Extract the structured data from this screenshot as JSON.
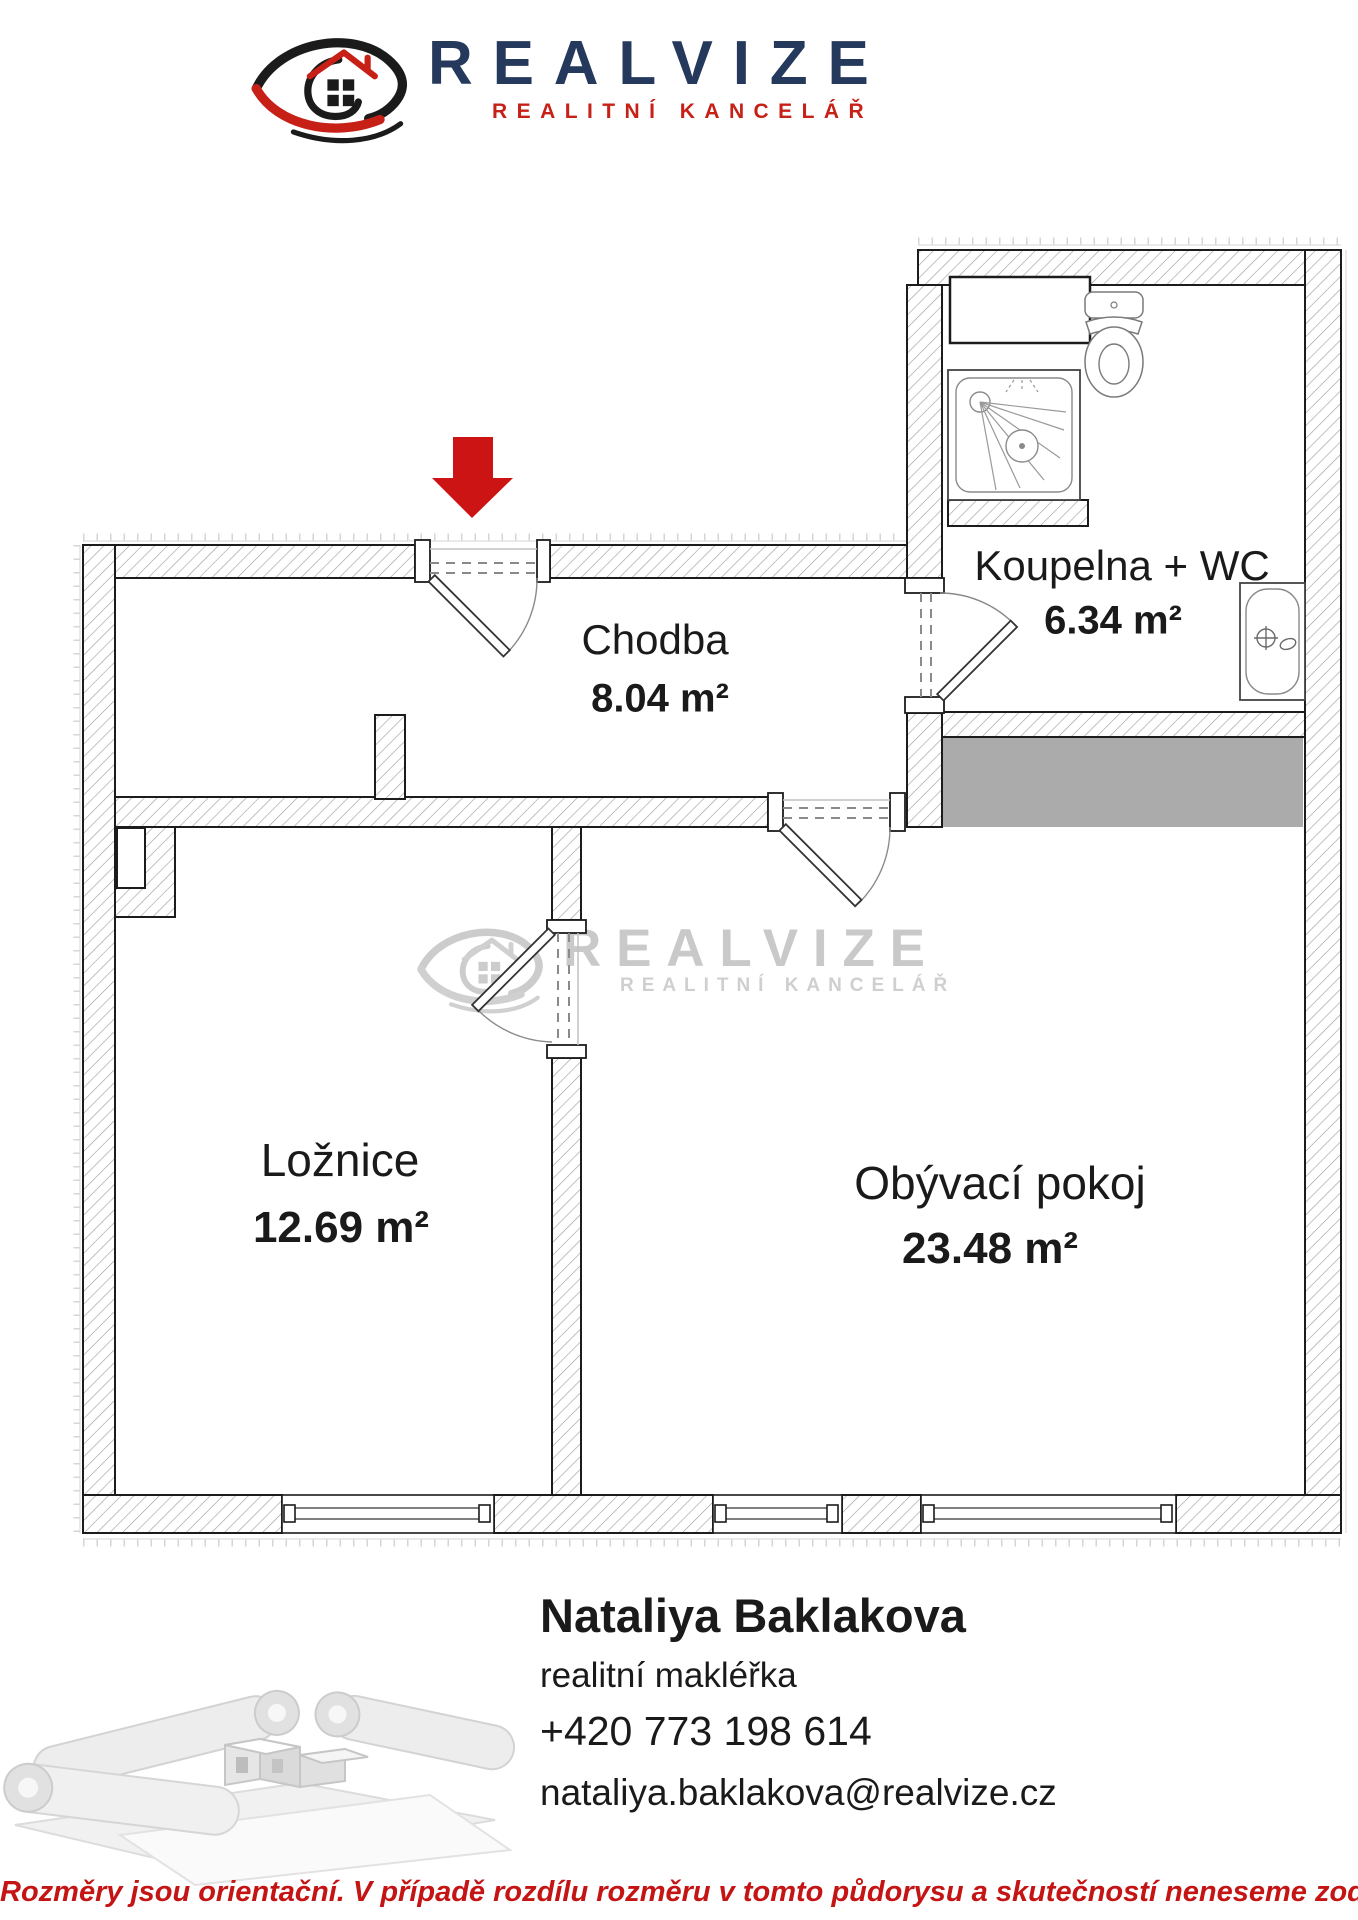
{
  "brand": {
    "name": "REALVIZE",
    "tagline": "REALITNÍ KANCELÁŘ",
    "navy": "#24395b",
    "red": "#c62017"
  },
  "watermark": {
    "name": "REALVIZE",
    "tagline": "REALITNÍ KANCELÁŘ"
  },
  "floorplan": {
    "rooms": [
      {
        "id": "chodba",
        "label": "Chodba",
        "area": "8.04 m²"
      },
      {
        "id": "koupelna",
        "label": "Koupelna + WC",
        "area": "6.34 m²"
      },
      {
        "id": "loznice",
        "label": "Ložnice",
        "area": "12.69 m²"
      },
      {
        "id": "obyvaci",
        "label": "Obývací pokoj",
        "area": "23.48 m²"
      }
    ],
    "entrance_arrow_color": "#cc1414",
    "neighbor_fill": "#ababab"
  },
  "icons": {
    "logo_eye": "eye-with-house-logo",
    "entrance_arrow": "red-down-arrow",
    "fixtures": [
      "shower",
      "toilet",
      "bathtub"
    ],
    "footer_photo": "rolled-blueprints-with-house-model"
  },
  "agent": {
    "name": "Nataliya Baklakova",
    "role": "realitní makléřka",
    "phone": "+420 773 198 614",
    "email": "nataliya.baklakova@realvize.cz"
  },
  "disclaimer": {
    "text": "Rozměry jsou orientační. V případě rozdílu rozměru v tomto půdorysu a skutečností neneseme zodpovědnost",
    "color": "#c41414"
  }
}
